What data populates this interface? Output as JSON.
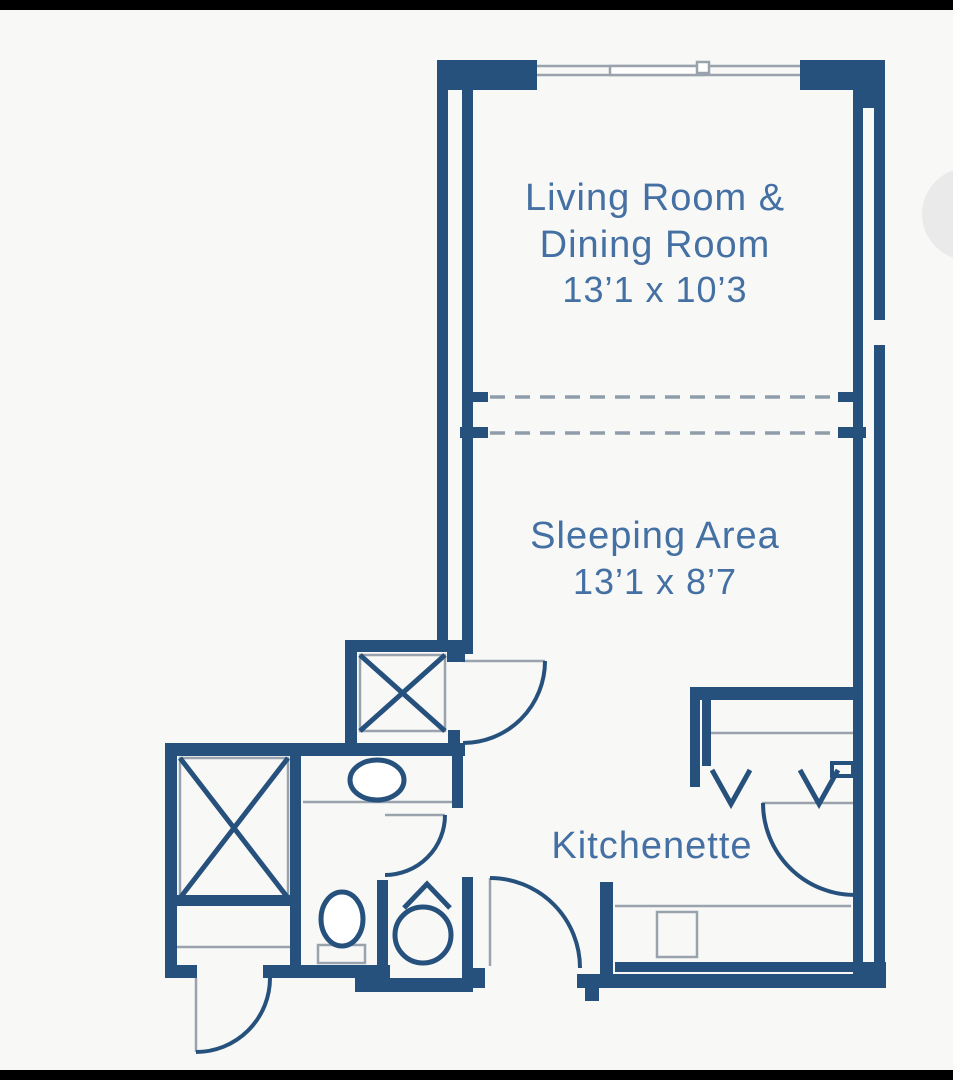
{
  "rooms": {
    "living": {
      "line1": "Living Room &",
      "line2": "Dining Room",
      "dims": "13’1 x 10’3"
    },
    "sleeping": {
      "name": "Sleeping Area",
      "dims": "13’1 x 8’7"
    },
    "kitchenette": {
      "name": "Kitchenette"
    }
  },
  "colors": {
    "wall": "#27517d",
    "text": "#4470a3",
    "thin_line": "#9aa3ad",
    "dash_line": "#8f9dab",
    "background": "#f8f8f6",
    "frame_bar": "#000000",
    "watermark": "#eaeaea"
  }
}
